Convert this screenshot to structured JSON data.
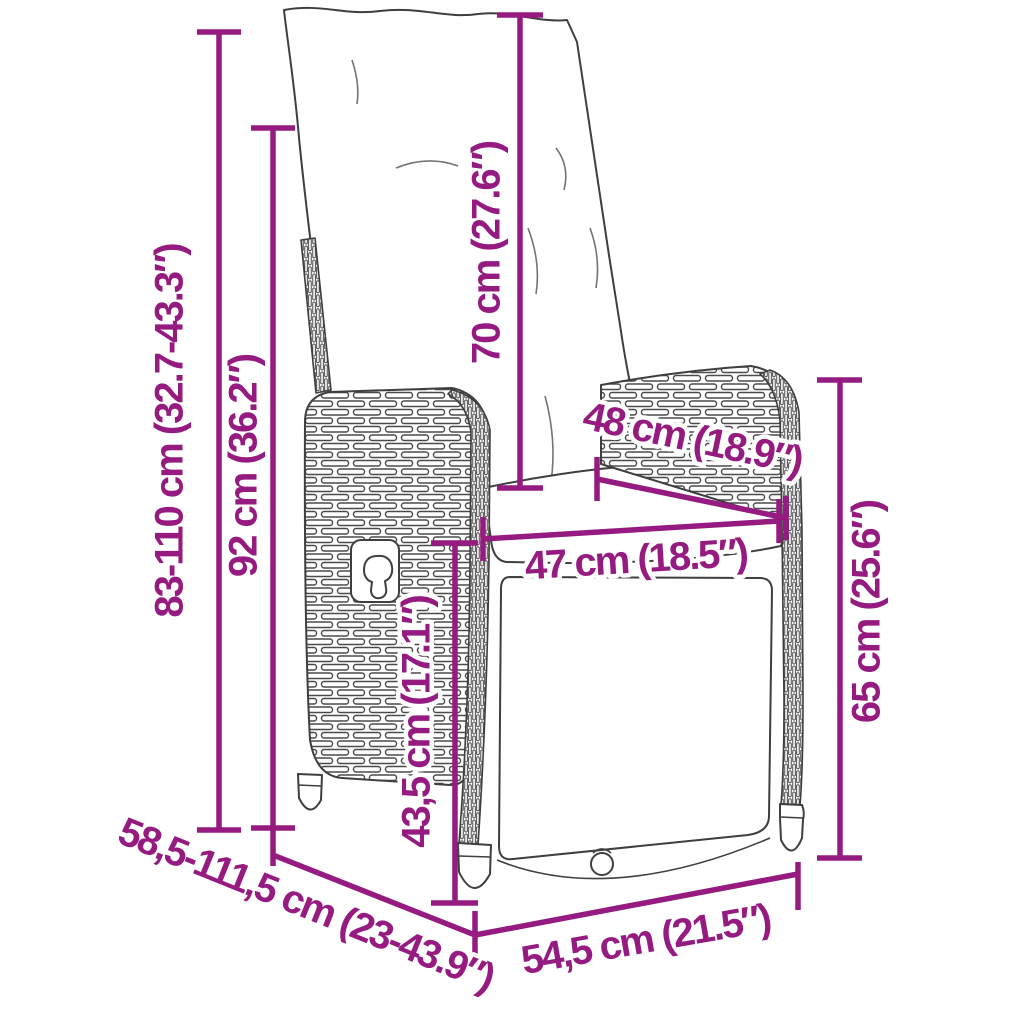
{
  "colors": {
    "annotation": "#951b81",
    "drawing_outline": "#3f3f3f",
    "background": "#ffffff"
  },
  "figure_type": "product-dimension-diagram",
  "dimensions": [
    {
      "id": "height-adjustable",
      "label": "83-110 cm (32.7-43.3″)"
    },
    {
      "id": "backrest-length",
      "label": "92 cm (36.2″)"
    },
    {
      "id": "cushion-length",
      "label": "70 cm (27.6″)"
    },
    {
      "id": "seat-depth",
      "label": "48 cm (18.9″)"
    },
    {
      "id": "seat-width",
      "label": "47 cm (18.5″)"
    },
    {
      "id": "side-height",
      "label": "65 cm (25.6″)"
    },
    {
      "id": "footrest-length",
      "label": "43,5 cm (17.1″)"
    },
    {
      "id": "depth-adjustable",
      "label": "58,5-111,5 cm (23-43.9″)"
    },
    {
      "id": "base-width",
      "label": "54,5 cm (21.5″)"
    }
  ]
}
